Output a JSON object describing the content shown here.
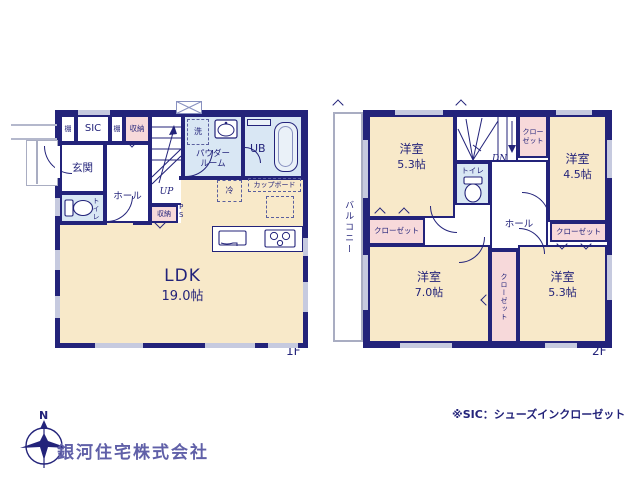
{
  "plan": {
    "floor1_label": "1F",
    "floor2_label": "2F",
    "f1": {
      "shelf": "棚",
      "sic": "SIC",
      "storage": "収納",
      "entrance": "玄関",
      "hall": "ホール",
      "up": "UP",
      "toilet": "トイレ",
      "ps_p": "P",
      "ps_s": "S",
      "washer": "洗",
      "powder_line1": "パウダー",
      "powder_line2": "ルーム",
      "ub": "UB",
      "fridge": "冷",
      "cupboard": "カップボード",
      "ldk_name": "LDK",
      "ldk_size": "19.0帖"
    },
    "f2": {
      "balcony": "バルコニー",
      "room_name": "洋室",
      "room_tl_size": "5.3帖",
      "room_tr_size": "4.5帖",
      "room_bl_size": "7.0帖",
      "room_br_size": "5.3帖",
      "dn": "DN",
      "closet": "クローゼット",
      "closet_top_line1": "クロー",
      "closet_top_line2": "ゼット",
      "toilet": "トイレ",
      "hall": "ホール"
    }
  },
  "footer": {
    "company": "銀河住宅株式会社",
    "note": "※SIC：シューズインクローゼット",
    "compass_n": "N"
  },
  "colors": {
    "wall": "#23237a",
    "room_cream": "#f8e9c9",
    "room_blue": "#d9e7f4",
    "room_pink": "#f7d9da",
    "window": "#c6cadf",
    "company_text": "#6060a8"
  }
}
